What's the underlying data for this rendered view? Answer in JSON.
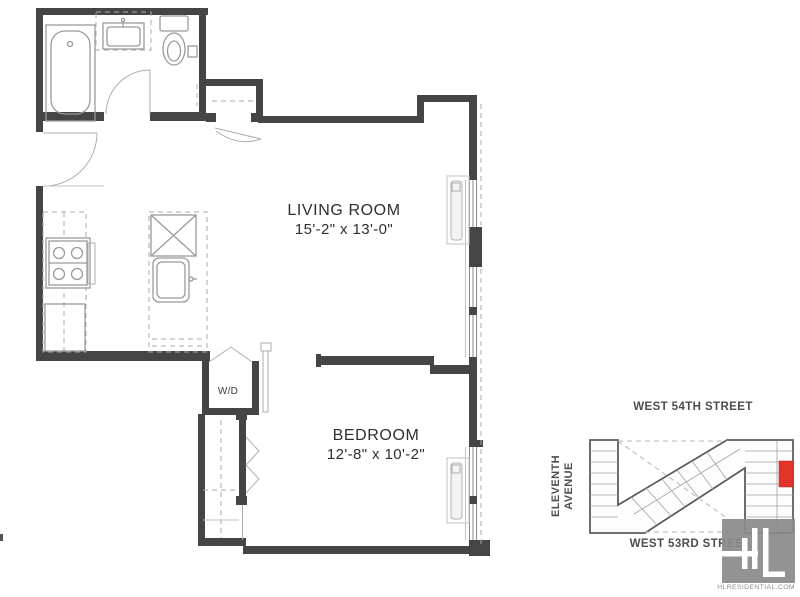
{
  "plan": {
    "rooms": [
      {
        "name": "LIVING ROOM",
        "dims": "15'-2\" x 13'-0\""
      },
      {
        "name": "BEDROOM",
        "dims": "12'-8\" x 10'-2\""
      }
    ],
    "washer_dryer": "W/D"
  },
  "site_map": {
    "street_top": "WEST 54TH STREET",
    "street_bottom": "WEST 53RD STREET",
    "avenue_line1": "ELEVENTH",
    "avenue_line2": "AVENUE",
    "unit_highlight_color": "#e3342b"
  },
  "branding": {
    "website": "HLRESIDENTIAL.COM",
    "logo_gray": "#8b8b8b"
  },
  "colors": {
    "walls": "#454545",
    "fixtures": "#9a9a9a"
  }
}
